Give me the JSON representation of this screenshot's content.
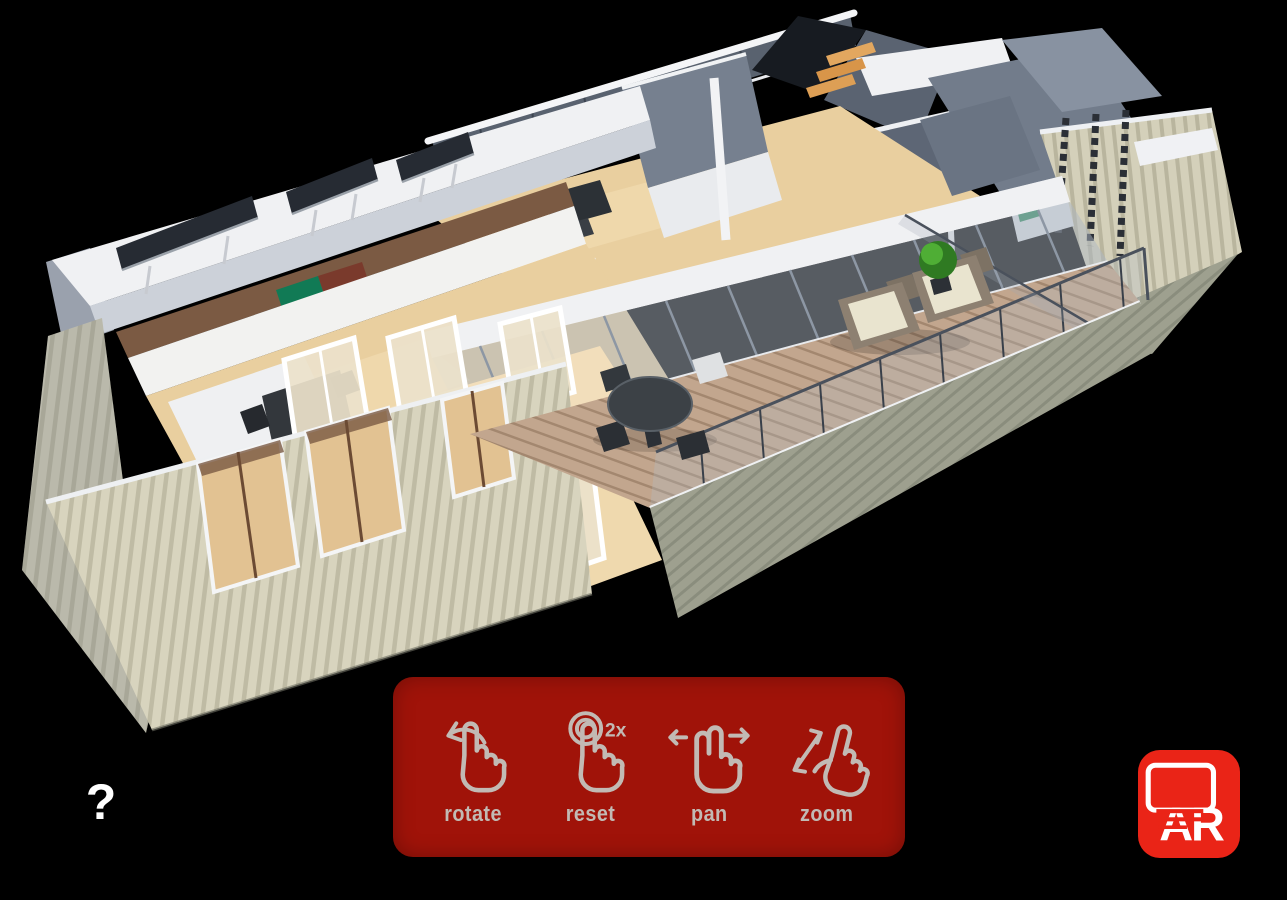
{
  "help": {
    "icon": "question-mark-icon",
    "label": "?"
  },
  "gesture_legend": {
    "items": [
      {
        "icon": "rotate-gesture-icon",
        "label": "rotate"
      },
      {
        "icon": "double-tap-gesture-icon",
        "label": "reset",
        "badge": "2x"
      },
      {
        "icon": "pan-gesture-icon",
        "label": "pan"
      },
      {
        "icon": "pinch-zoom-gesture-icon",
        "label": "zoom"
      }
    ]
  },
  "ar_button": {
    "icon": "ar-screen-icon",
    "label": "AR"
  },
  "colors": {
    "background": "#000000",
    "legend-red": "#a01309",
    "ar-red": "#ea2417",
    "icon-gray": "#c2bab4",
    "wall-white": "#f0f1f3",
    "slate": "#727c8b",
    "wood-floor": "#e9cf9f",
    "deck-wood": "#c2a68e",
    "siding-cream": "#d8d4be",
    "skirt-gray": "#9ea08f",
    "plant-green": "#46a032",
    "stair-wood": "#dd9f55",
    "dark-panel": "#262b33"
  }
}
